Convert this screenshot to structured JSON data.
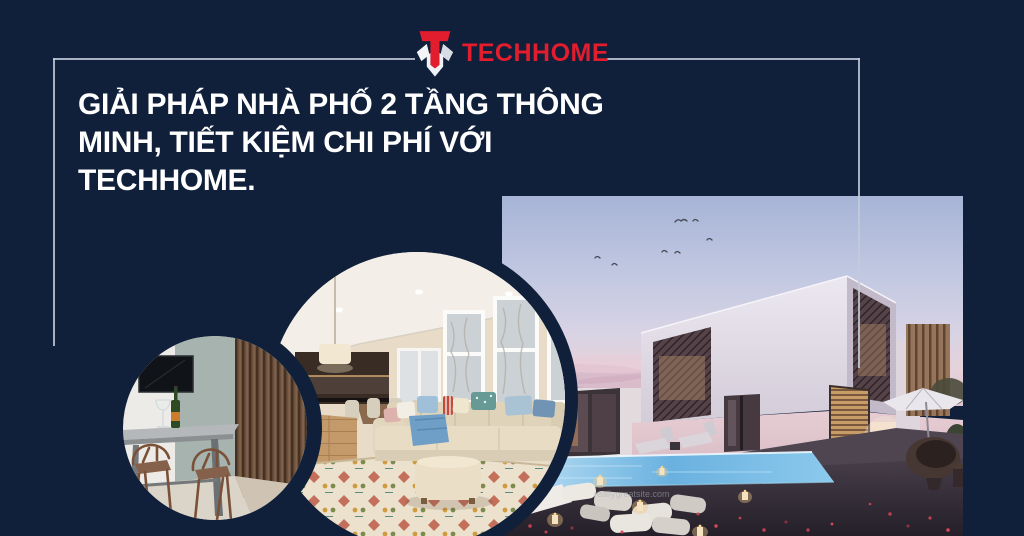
{
  "theme": {
    "background": "#101f3a",
    "frame_line": "#c2cbd9",
    "brand_red": "#e11d2e",
    "headline_color": "#ffffff",
    "pool_blue": "#6ab1e0",
    "dusk_sky_top": "#a7b4d6",
    "dusk_sky_pink": "#e5d2da"
  },
  "logo": {
    "text": "TECHHOME"
  },
  "headline": {
    "text": "GIẢI PHÁP NHÀ PHỐ 2 TẦNG THÔNG\nMINH, TIẾT KIỆM CHI PHÍ VỚI\nTECHHOME."
  },
  "hero": {
    "watermark_left": "Any Cit",
    "watermark_site": "reallygreatsite.com"
  }
}
